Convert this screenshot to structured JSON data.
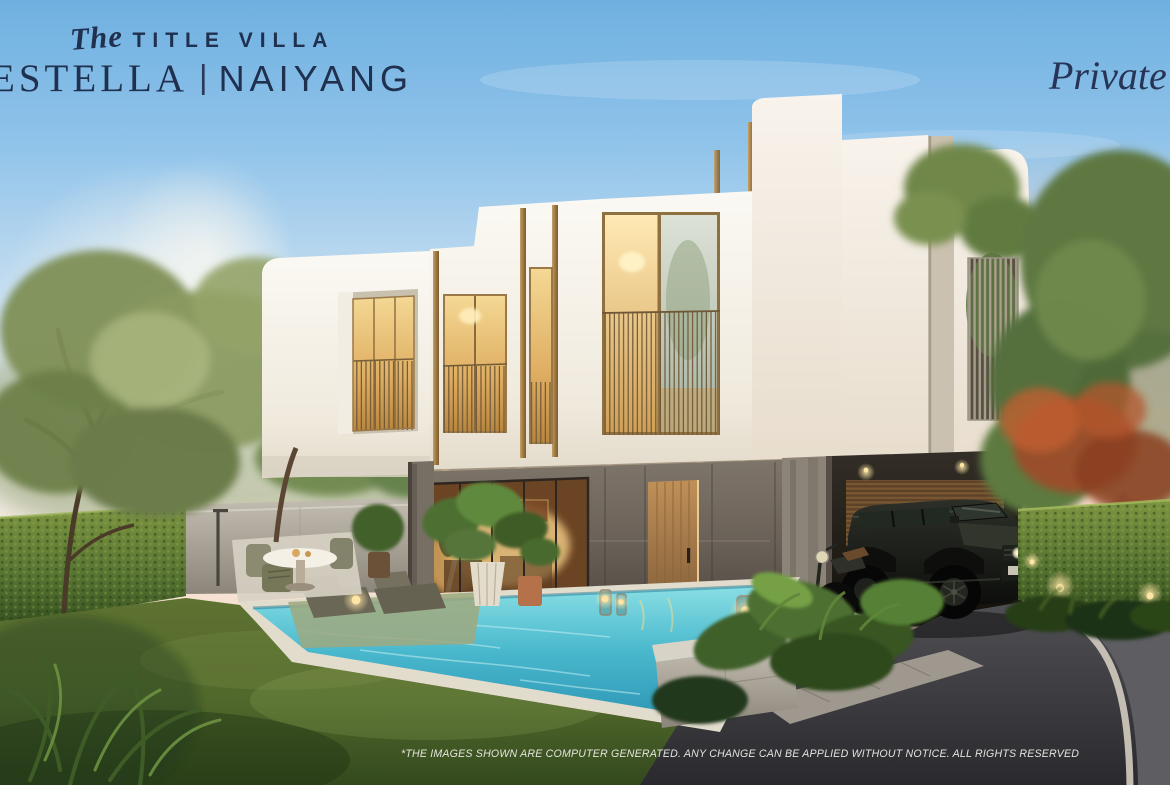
{
  "branding": {
    "prefix": "The",
    "title": "TITLE VILLA",
    "name_left": "ESTELLA",
    "divider": "|",
    "name_right": "NAIYANG",
    "tagline": "Private"
  },
  "footer": {
    "disclaimer": "*THE IMAGES SHOWN ARE COMPUTER GENERATED. ANY CHANGE CAN BE APPLIED WITHOUT NOTICE. ALL RIGHTS RESERVED"
  },
  "palette": {
    "brand_navy": "#20304f",
    "sky_blue": "#79b7e2",
    "sunset_pink": "#f3cfc0",
    "mountain_mauve": "#b78c95",
    "villa_white": "#f4f1ea",
    "wood_bronze": "#a98a5c",
    "warm_window_glow": "#f0cf8a",
    "marble_grey": "#6f675e",
    "pool_water": "#35b2cd",
    "lawn_green": "#4e6429",
    "hedge_green": "#5d7a33",
    "asphalt_grey": "#3a3a3e"
  },
  "scene": {
    "objects": [
      "two-storey modern white villa with bronze trims",
      "warm lit bedroom windows with balcony railings",
      "rooftop louver screen with terrace trees",
      "marble ground floor with glass doors and wooden door",
      "carport with black suv and motorcycle",
      "swimming pool with in-pool sun loungers and steps",
      "outdoor dining set and shower",
      "candle lanterns and potted plants",
      "garden lawn, hedge fences, trees",
      "sunset sky with distant mountain"
    ]
  }
}
